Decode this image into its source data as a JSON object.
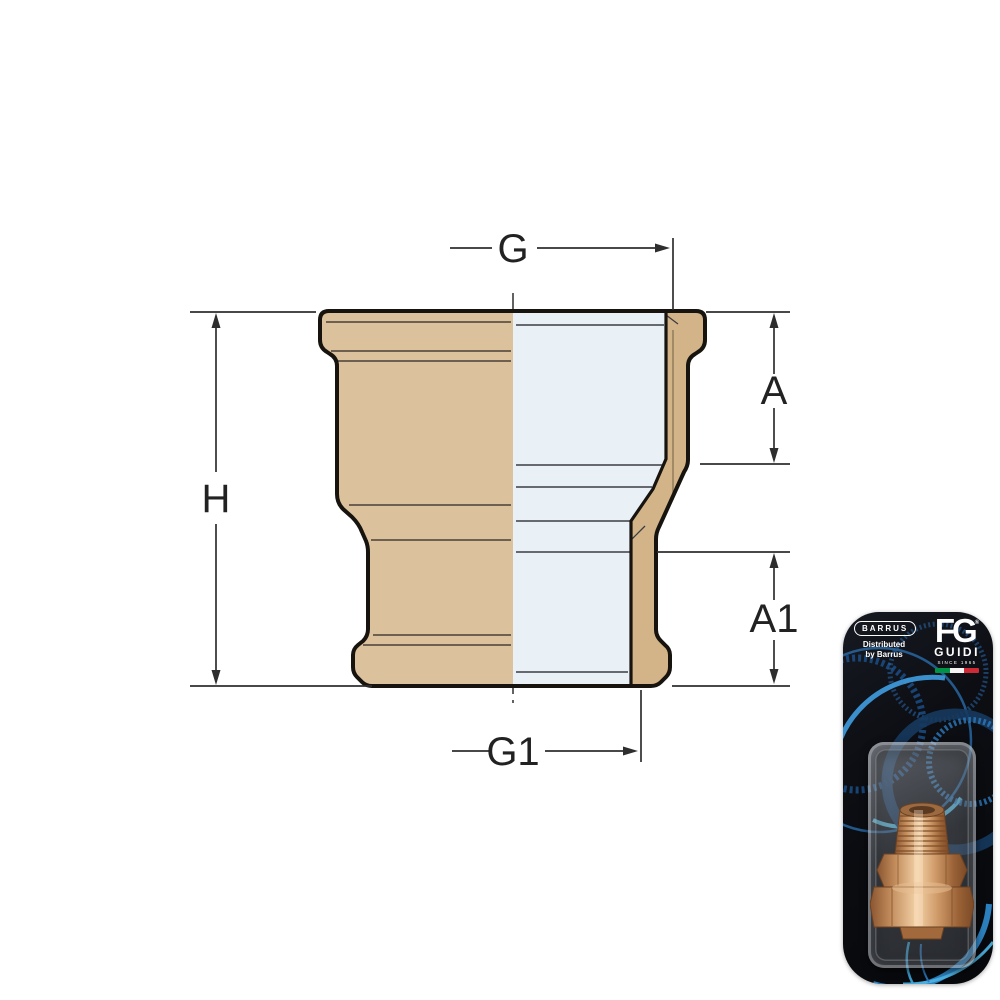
{
  "diagram": {
    "labels": {
      "g": "G",
      "h": "H",
      "a": "A",
      "a1": "A1",
      "g1": "G1"
    }
  },
  "packaging": {
    "barrus_logo": "BARRUS",
    "distributed_line1": "Distributed",
    "distributed_line2": "by Barrus",
    "fg_monogram": "FG",
    "reg_mark": "®",
    "guidi": "GUIDI",
    "since": "SINCE 1965"
  },
  "colors": {
    "part_tan": "#dcc19d",
    "part_tan_dark": "#d2b488",
    "section_blue": "#e9f0f6",
    "outline": "#17130e",
    "dimension_line": "#2e2e2e",
    "card_black": "#0c0e13",
    "swirl_blue": "#2d79bd",
    "swirl_cyan": "#57c4ec",
    "brass": "#c98f60",
    "flag_green": "#009246",
    "flag_white": "#f4f4f4",
    "flag_red": "#ce2b37"
  }
}
